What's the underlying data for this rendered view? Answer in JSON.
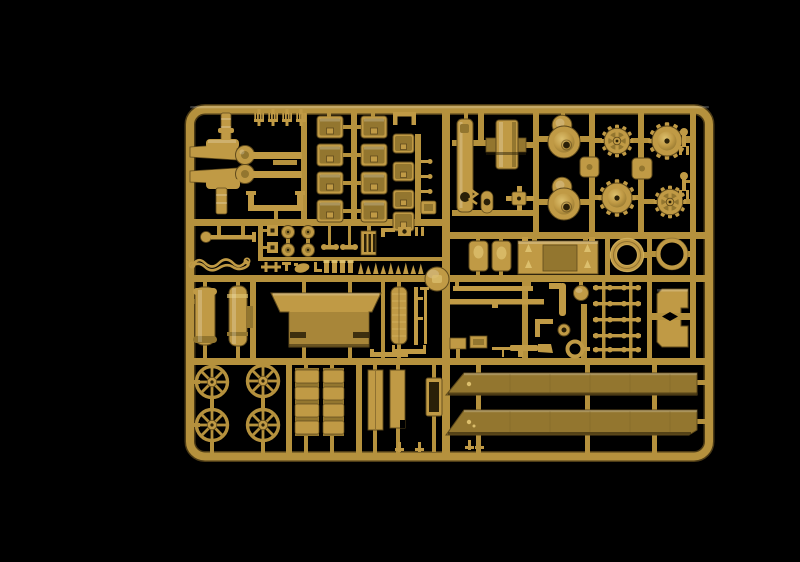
{
  "meta": {
    "description": "Photograph of an injection-molded plastic model kit sprue (parts tree) in dark sand-yellow polystyrene, laid on a solid black background",
    "subject": "military vehicle model kit sprue",
    "background_color_name": "black",
    "plastic_color_name": "dark yellow / sand tan"
  },
  "palette": {
    "background": "#000000",
    "plastic": "#b5913d",
    "plastic_mid": "#c09a45",
    "plastic_hi": "#dcbf6d",
    "plastic_low": "#93762f",
    "plastic_dark": "#5f4a1c",
    "plastic_deep": "#2a2008"
  },
  "sprue": {
    "frame_shape": "rounded rectangle with internal runner grid",
    "part_groups": [
      {
        "name": "cleaning-tool-forks",
        "count": 4,
        "location": "top-left, hanging from top rail"
      },
      {
        "name": "gun-cradle-arms",
        "count": 2,
        "location": "top-left"
      },
      {
        "name": "u-channel-bracket",
        "count": 1,
        "location": "top-left"
      },
      {
        "name": "stowage-boxes",
        "count": 12,
        "location": "top-middle, three columns"
      },
      {
        "name": "tall-mount-plate",
        "count": 1,
        "location": "top-right, left column"
      },
      {
        "name": "cylinder-with-flange",
        "count": 1,
        "location": "top-right"
      },
      {
        "name": "domed-roadwheel-halves",
        "count": 2,
        "location": "top-right"
      },
      {
        "name": "spoked-sprocket-wheels",
        "count": 2,
        "location": "top-right"
      },
      {
        "name": "domed-drive-sprockets",
        "count": 2,
        "location": "top-right"
      },
      {
        "name": "square-caps",
        "count": 2,
        "location": "top-right"
      },
      {
        "name": "fork-tools",
        "count": 2,
        "location": "right edge"
      },
      {
        "name": "axle-with-disc",
        "count": 1,
        "location": "middle-left band"
      },
      {
        "name": "tow-cable",
        "count": 1,
        "location": "middle-left band"
      },
      {
        "name": "pulley-discs",
        "count": 4,
        "location": "middle-left band"
      },
      {
        "name": "small-fittings",
        "count": 20,
        "location": "middle band rows"
      },
      {
        "name": "ball-mount-dome",
        "count": 1,
        "location": "center of middle rail"
      },
      {
        "name": "oval-boss-covers",
        "count": 2,
        "location": "middle-right band"
      },
      {
        "name": "engine-hatch-plate",
        "count": 1,
        "location": "middle-right band"
      },
      {
        "name": "tire-rings",
        "count": 2,
        "location": "middle-right band"
      },
      {
        "name": "exhaust-cylinders",
        "count": 2,
        "location": "center-left band"
      },
      {
        "name": "glacis-plate",
        "count": 1,
        "location": "center band"
      },
      {
        "name": "slatted-filter-cylinder",
        "count": 1,
        "location": "center band"
      },
      {
        "name": "thin-rods",
        "count": 2,
        "location": "center band"
      },
      {
        "name": "thin-tie-bars",
        "count": 2,
        "location": "center-right band"
      },
      {
        "name": "pipe-and-small-fittings",
        "count": 6,
        "location": "center-right band"
      },
      {
        "name": "machine-gun",
        "count": 1,
        "location": "center-right band"
      },
      {
        "name": "track-link-ladder-rows",
        "count": 5,
        "location": "center-right band"
      },
      {
        "name": "access-panels",
        "count": 2,
        "location": "center-right band"
      },
      {
        "name": "spoked-road-wheels",
        "count": 4,
        "location": "bottom-left, 2x2"
      },
      {
        "name": "track-sections",
        "count": 2,
        "location": "bottom-middle"
      },
      {
        "name": "skirt-strips",
        "count": 2,
        "location": "bottom-middle"
      },
      {
        "name": "long-fenders",
        "count": 2,
        "location": "bottom-right"
      }
    ]
  }
}
